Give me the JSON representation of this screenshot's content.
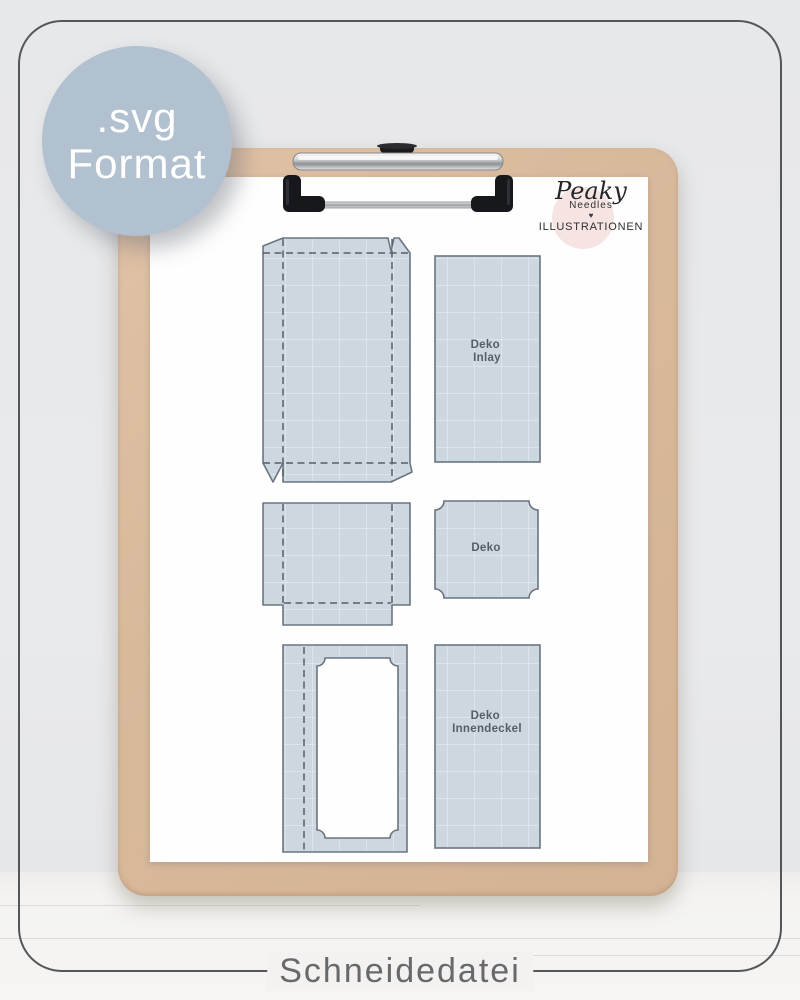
{
  "badge": {
    "line1": ".svg",
    "line2": "Format"
  },
  "logo": {
    "brand": "Peaky",
    "sub": "Needles",
    "heart": "♥",
    "tagline": "ILLUSTRATIONEN"
  },
  "caption": "Schneidedatei",
  "templates": {
    "labels": {
      "inlay": [
        "Deko",
        "Inlay"
      ],
      "deko": [
        "Deko"
      ],
      "innendeckel": [
        "Deko",
        "Innendeckel"
      ]
    }
  },
  "colors": {
    "badge_bg": "#b2c1cf",
    "badge_text": "#ffffff",
    "frame_border": "#53565a",
    "caption_text": "#67696d",
    "wall": "#e9eaec",
    "floor": "#f4f3f1",
    "clipboard": "#d9b99c",
    "paper": "#fefefe",
    "template_fill": "#cdd7df",
    "template_grid": "#e4ebf0",
    "template_outline": "#6b7580",
    "template_dash": "#565f6a",
    "template_label": "#555e66",
    "logo_circle": "#f6e4e3"
  }
}
